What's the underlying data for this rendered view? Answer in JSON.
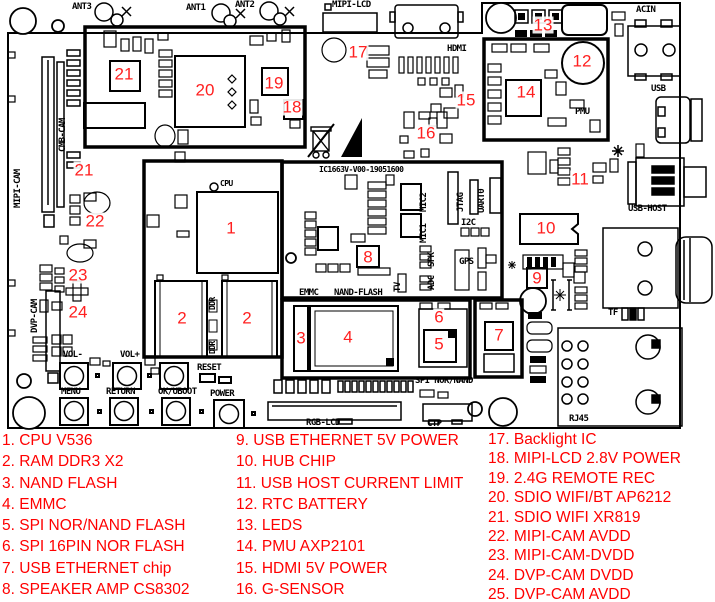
{
  "colors": {
    "silkscreen": "#000000",
    "marker_red": "#ff2020",
    "legend_red": "#ff0000",
    "board_bg": "#ffffff"
  },
  "board": {
    "silkscreen_id": "IC1663V-V00-19051600",
    "labels": {
      "ant3": "ANT3",
      "ant1": "ANT1",
      "ant2": "ANT2",
      "mipi_lcd": "MIPI-LCD",
      "hdmi": "HDMI",
      "acin": "ACIN",
      "usb": "USB",
      "pmu": "PMU",
      "usb_host": "USB-HOST",
      "tf": "TF",
      "rj45": "RJ45",
      "rgb_lcd": "RGB-LCD",
      "ctp": "CTP",
      "spi_nor_nand": "SPI NOR/NAND",
      "emmc": "EMMC",
      "nand_flash": "NAND-FLASH",
      "mipi_cam": "MIPI-CAM",
      "cmb_cam": "CMB-CAM",
      "dvp_cam": "DVP-CAM",
      "cpu": "CPU",
      "ddr": "DDR",
      "jtag": "JTAG",
      "uart0": "UART0",
      "i2c": "I2C",
      "gps": "GPS",
      "mic2": "MIC2",
      "mic1": "MIC1",
      "spk": "SPK",
      "tv": "TV",
      "adc": "ADC",
      "vol_minus": "VOL-",
      "vol_plus": "VOL+",
      "reset": "RESET",
      "menu": "MENU",
      "return": "RETURN",
      "ok_uboot": "OK/UBOOT",
      "power": "POWER"
    },
    "markers": {
      "n1": "1",
      "n2": "2",
      "n3": "3",
      "n4": "4",
      "n5": "5",
      "n6": "6",
      "n7": "7",
      "n8": "8",
      "n9": "9",
      "n10": "10",
      "n11": "11",
      "n12": "12",
      "n13": "13",
      "n14": "14",
      "n15": "15",
      "n16": "16",
      "n17": "17",
      "n18": "18",
      "n19": "19",
      "n20": "20",
      "n21": "21",
      "n22": "22",
      "n23": "23",
      "n24": "24"
    }
  },
  "legend": {
    "col1": [
      "1. CPU V536",
      "2. RAM DDR3 X2",
      "3. NAND FLASH",
      "4. EMMC",
      "5. SPI NOR/NAND FLASH",
      "6. SPI 16PIN NOR FLASH",
      "7. USB ETHERNET chip",
      "8. SPEAKER AMP CS8302"
    ],
    "col2": [
      "9. USB ETHERNET 5V POWER",
      "10. HUB CHIP",
      "11. USB HOST CURRENT LIMIT",
      "12. RTC BATTERY",
      "13. LEDS",
      "14. PMU AXP2101",
      "15. HDMI 5V POWER",
      "16. G-SENSOR"
    ],
    "col3": [
      "17. Backlight IC",
      "18. MIPI-LCD 2.8V POWER",
      "19. 2.4G REMOTE REC",
      "20. SDIO WIFI/BT AP6212",
      "21. SDIO WIFI XR819",
      "22. MIPI-CAM AVDD",
      "23. MIPI-CAM-DVDD",
      "24. DVP-CAM DVDD",
      "25. DVP-CAM AVDD"
    ]
  }
}
